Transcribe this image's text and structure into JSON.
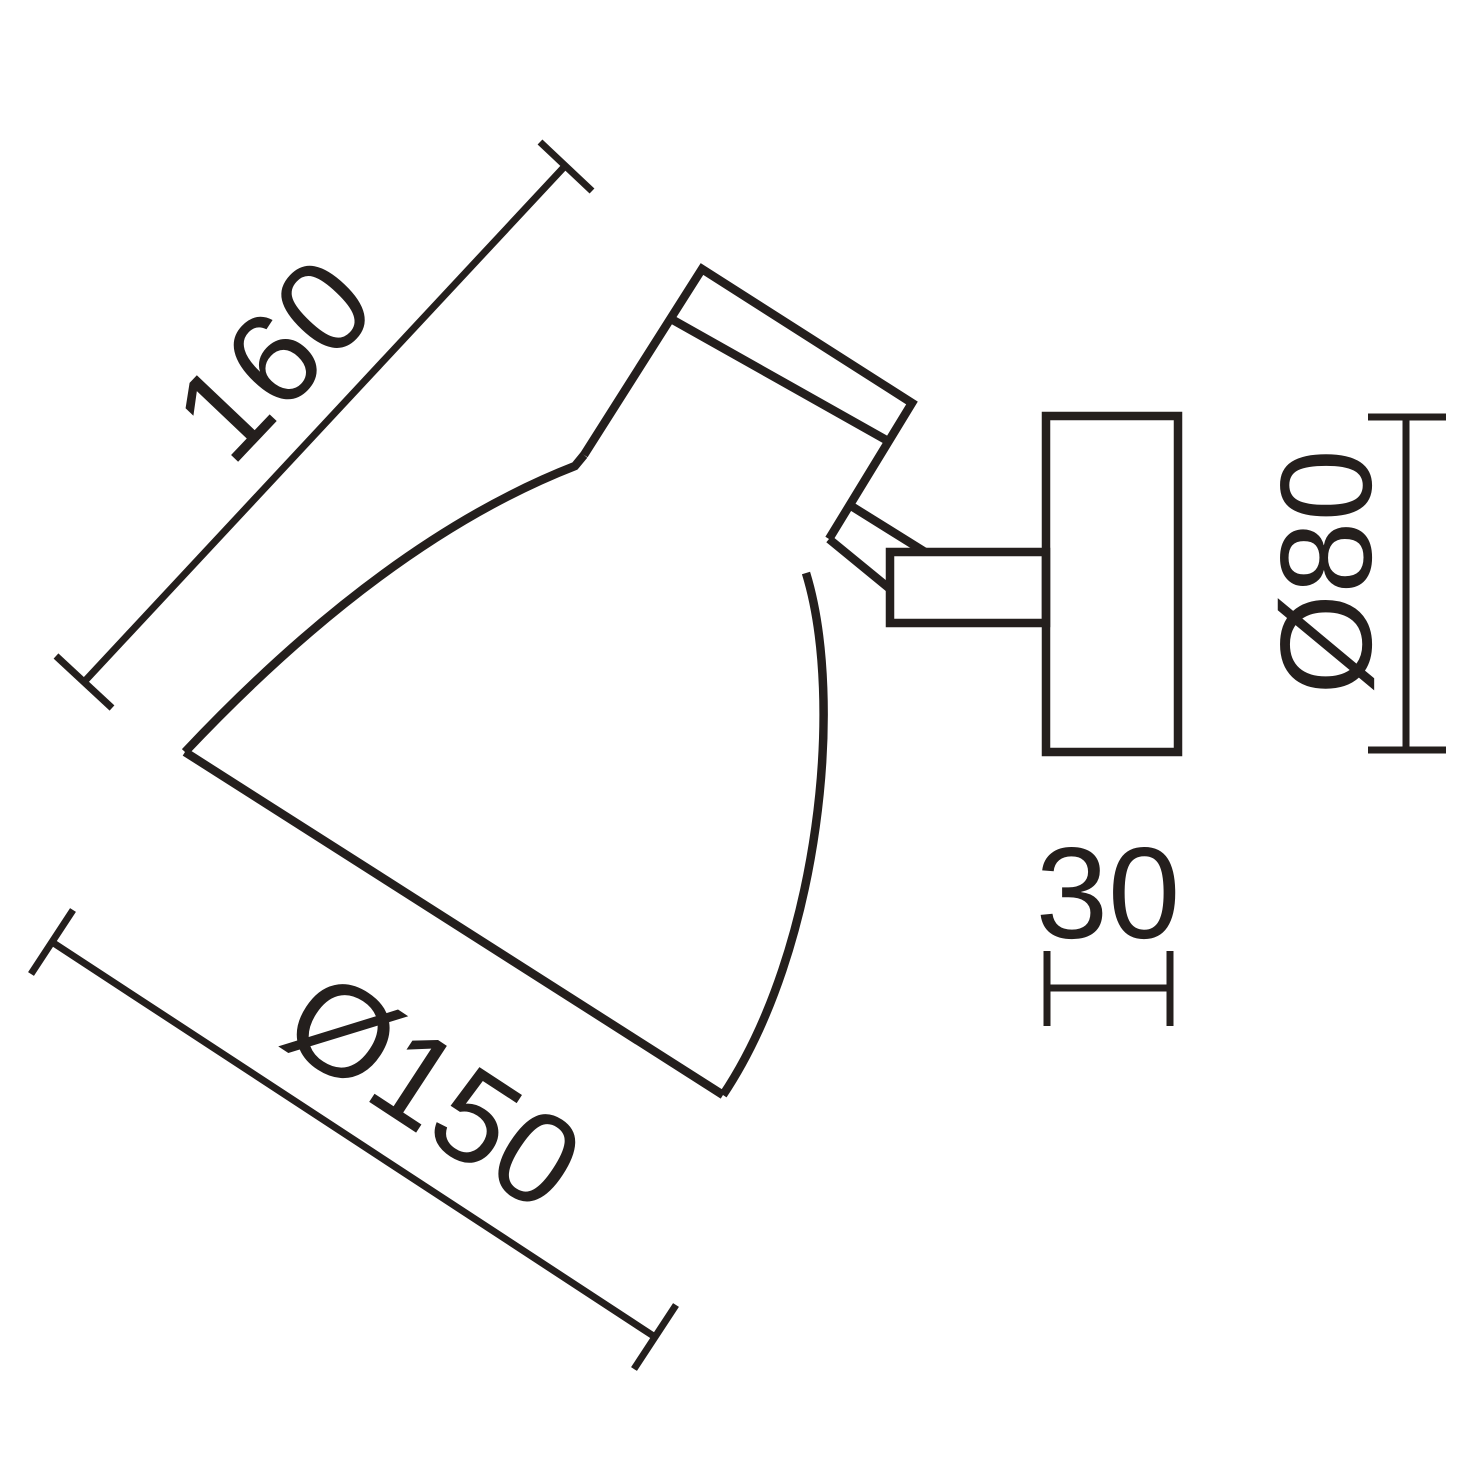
{
  "drawing": {
    "background": "#ffffff",
    "line_color": "#241f1d",
    "labels": {
      "shade_length": "160",
      "shade_diameter": "Ø150",
      "base_diameter": "Ø80",
      "base_depth": "30"
    }
  }
}
